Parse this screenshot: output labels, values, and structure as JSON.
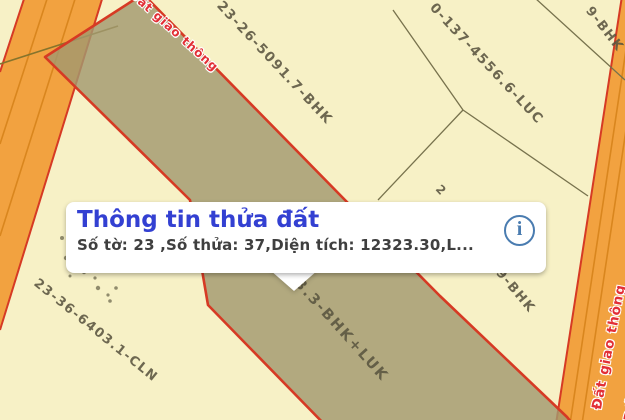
{
  "popup": {
    "title": "Thông tin thửa đất",
    "details": "Số tờ: 23 ,Số thửa: 37,Diện tích: 12323.30,L...",
    "info_icon_glyph": "i"
  },
  "map": {
    "parcel_labels": [
      {
        "text": "23-26-5091.7-BHK"
      },
      {
        "text": "0-137-4556.6-LUC"
      },
      {
        "text": "9-BHK"
      },
      {
        "text": "3.3-BHK+LUK"
      },
      {
        "text": "23-36-6403.1-CLN"
      },
      {
        "text": "9-BHK"
      },
      {
        "text": "2"
      }
    ],
    "road_labels": [
      {
        "text": "Đất giao thông"
      },
      {
        "text": "Đất giao thông"
      },
      {
        "text": "Đất giao thông"
      }
    ],
    "colors": {
      "parcel_fill": "#f7f1c6",
      "road_fill": "#f2a240",
      "road_lane_line": "#d9861e",
      "boundary_red": "#d63a24",
      "boundary_thin": "#77724d",
      "selected_parcel_fill": "#b3aa80",
      "parcel_label_text": "#5a5540",
      "road_label_text": "#e22f36",
      "popup_title": "#3340d2",
      "popup_details": "#3f3f3f",
      "info_icon": "#4a7cb0"
    }
  }
}
